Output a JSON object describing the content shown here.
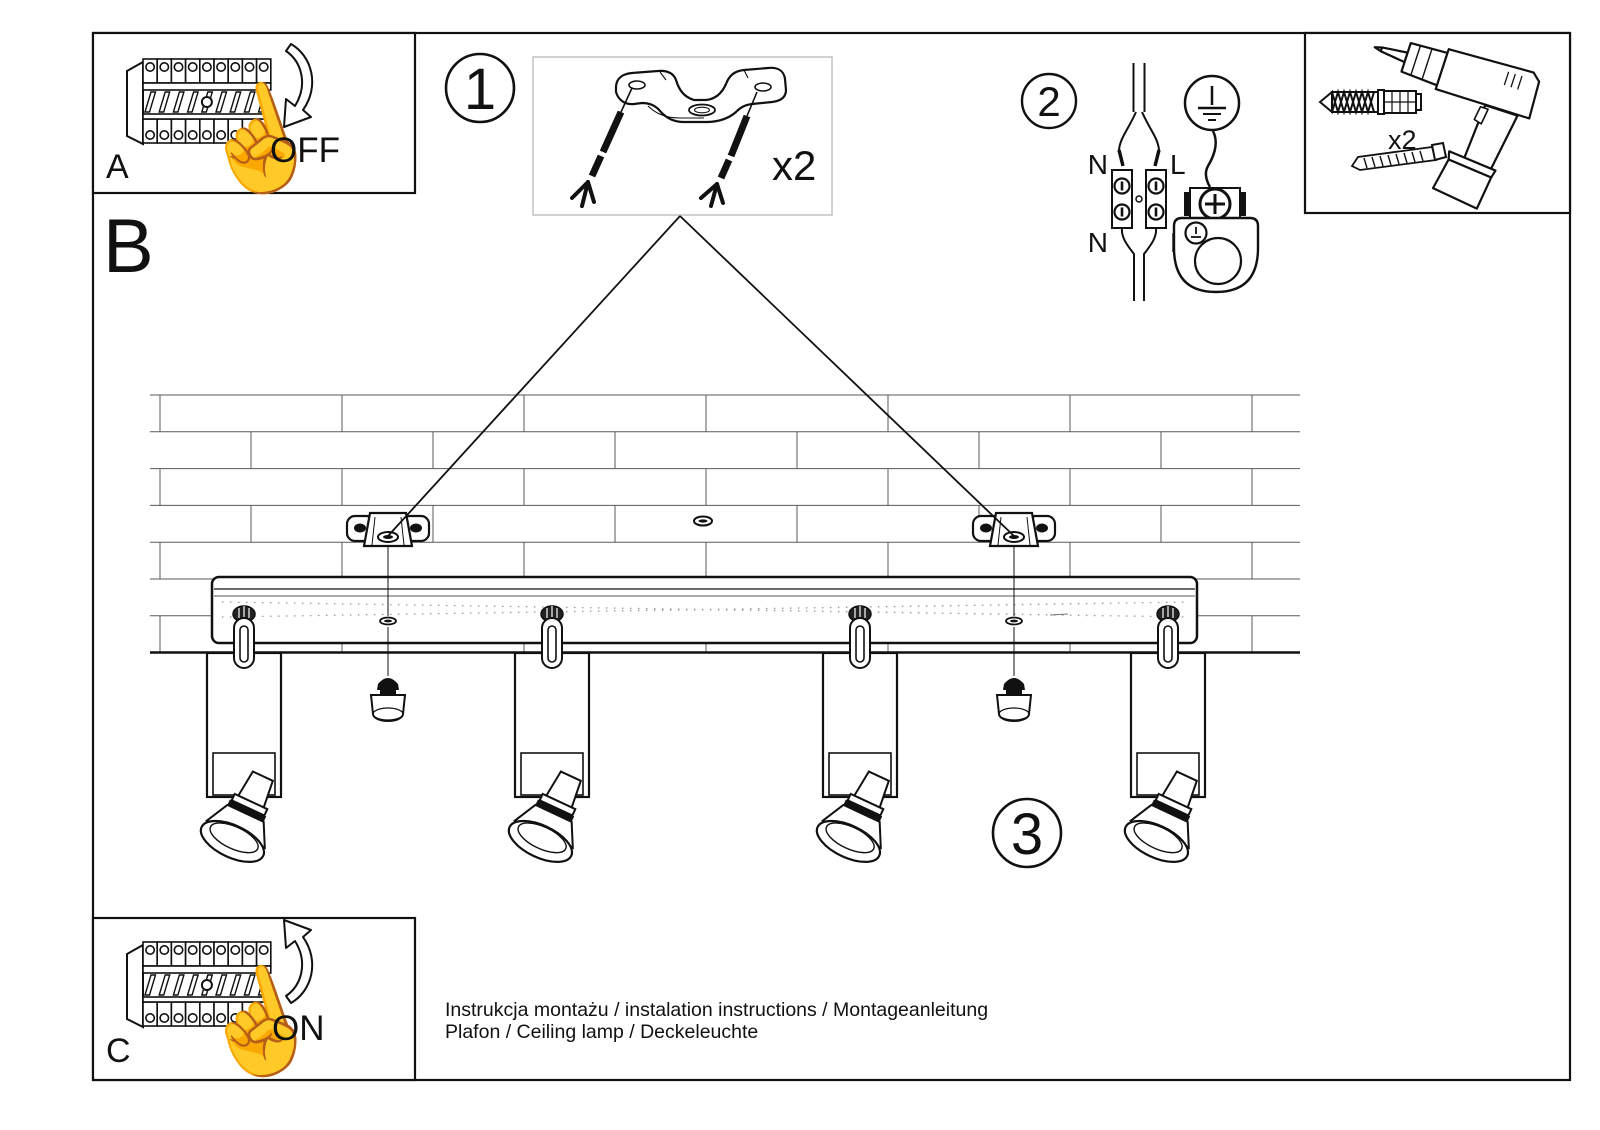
{
  "sheet": {
    "panels": {
      "a": {
        "label": "A",
        "action": "OFF"
      },
      "b": {
        "label": "B"
      },
      "c": {
        "label": "C",
        "action": "ON"
      }
    },
    "steps": {
      "one": "1",
      "two": "2",
      "three": "3"
    },
    "parts": {
      "bracket_qty": "x2",
      "anchor_qty": "x2"
    },
    "wiring": {
      "n_top": "N",
      "l_top": "L",
      "n_bottom": "N",
      "l_bottom": "L"
    },
    "icons": {
      "hand": "☝"
    },
    "footer": {
      "line1": "Instrukcja montażu / instalation instructions / Montageanleitung",
      "line2": "Plafon / Ceiling lamp / Deckeleuchte"
    },
    "colors": {
      "line": "#111111",
      "paper": "#ffffff",
      "faint": "#bbbbbb"
    }
  }
}
